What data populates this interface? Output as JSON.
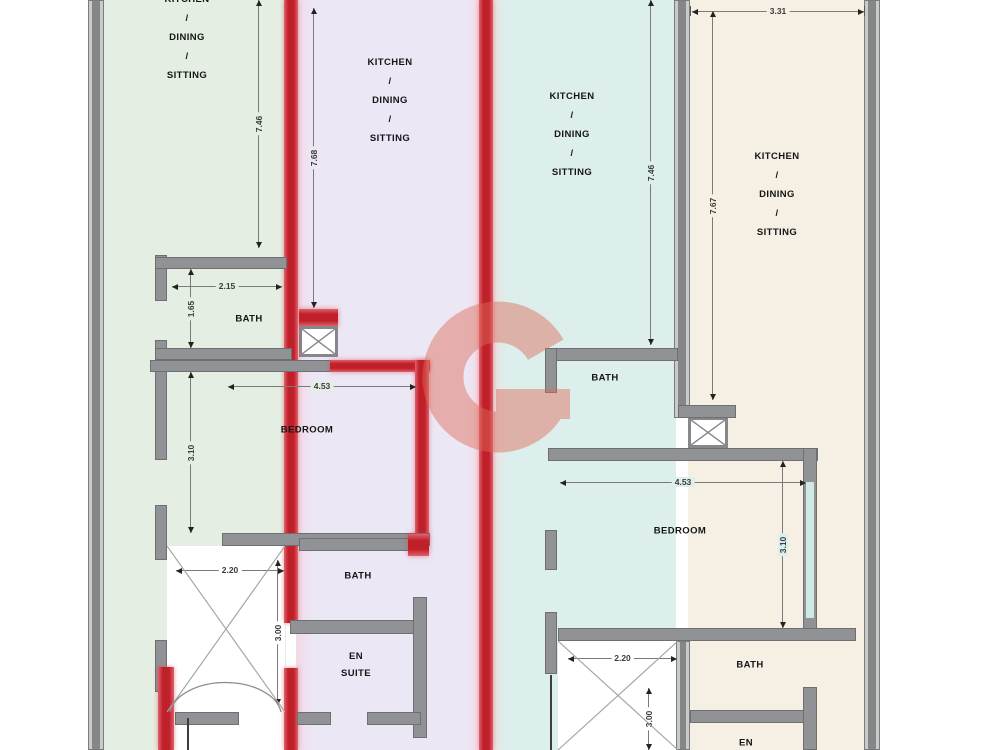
{
  "units": [
    {
      "living_height": "7.46",
      "bath_width": "2.15",
      "bath_height": "1.65",
      "bedroom_width": "4.53",
      "bedroom_height": "3.10",
      "shaft_width": "2.20",
      "shaft_height": "3.00"
    },
    {
      "living_height": "7.68"
    },
    {
      "living_height": "7.46",
      "bedroom_width": "4.53",
      "bedroom_height": "3.10",
      "shaft_width": "2.20",
      "shaft_height": "3.00"
    },
    {
      "living_height": "7.67",
      "top_width": "3.31"
    }
  ],
  "labels": {
    "living": [
      "KITCHEN",
      "/",
      "DINING",
      "/",
      "SITTING"
    ],
    "bath": "BATH",
    "bedroom": "BEDROOM",
    "ensuite": [
      "EN",
      "SUITE"
    ],
    "en": "EN"
  },
  "colors": {
    "unit1_floor": "#e4eee2",
    "unit2_floor": "#ece7f5",
    "unit3_floor": "#ddefec",
    "unit4_floor": "#f5f0e3",
    "wall_gray": "#909295",
    "wall_red": "#c0202a",
    "watermark": "#dd6a57"
  }
}
